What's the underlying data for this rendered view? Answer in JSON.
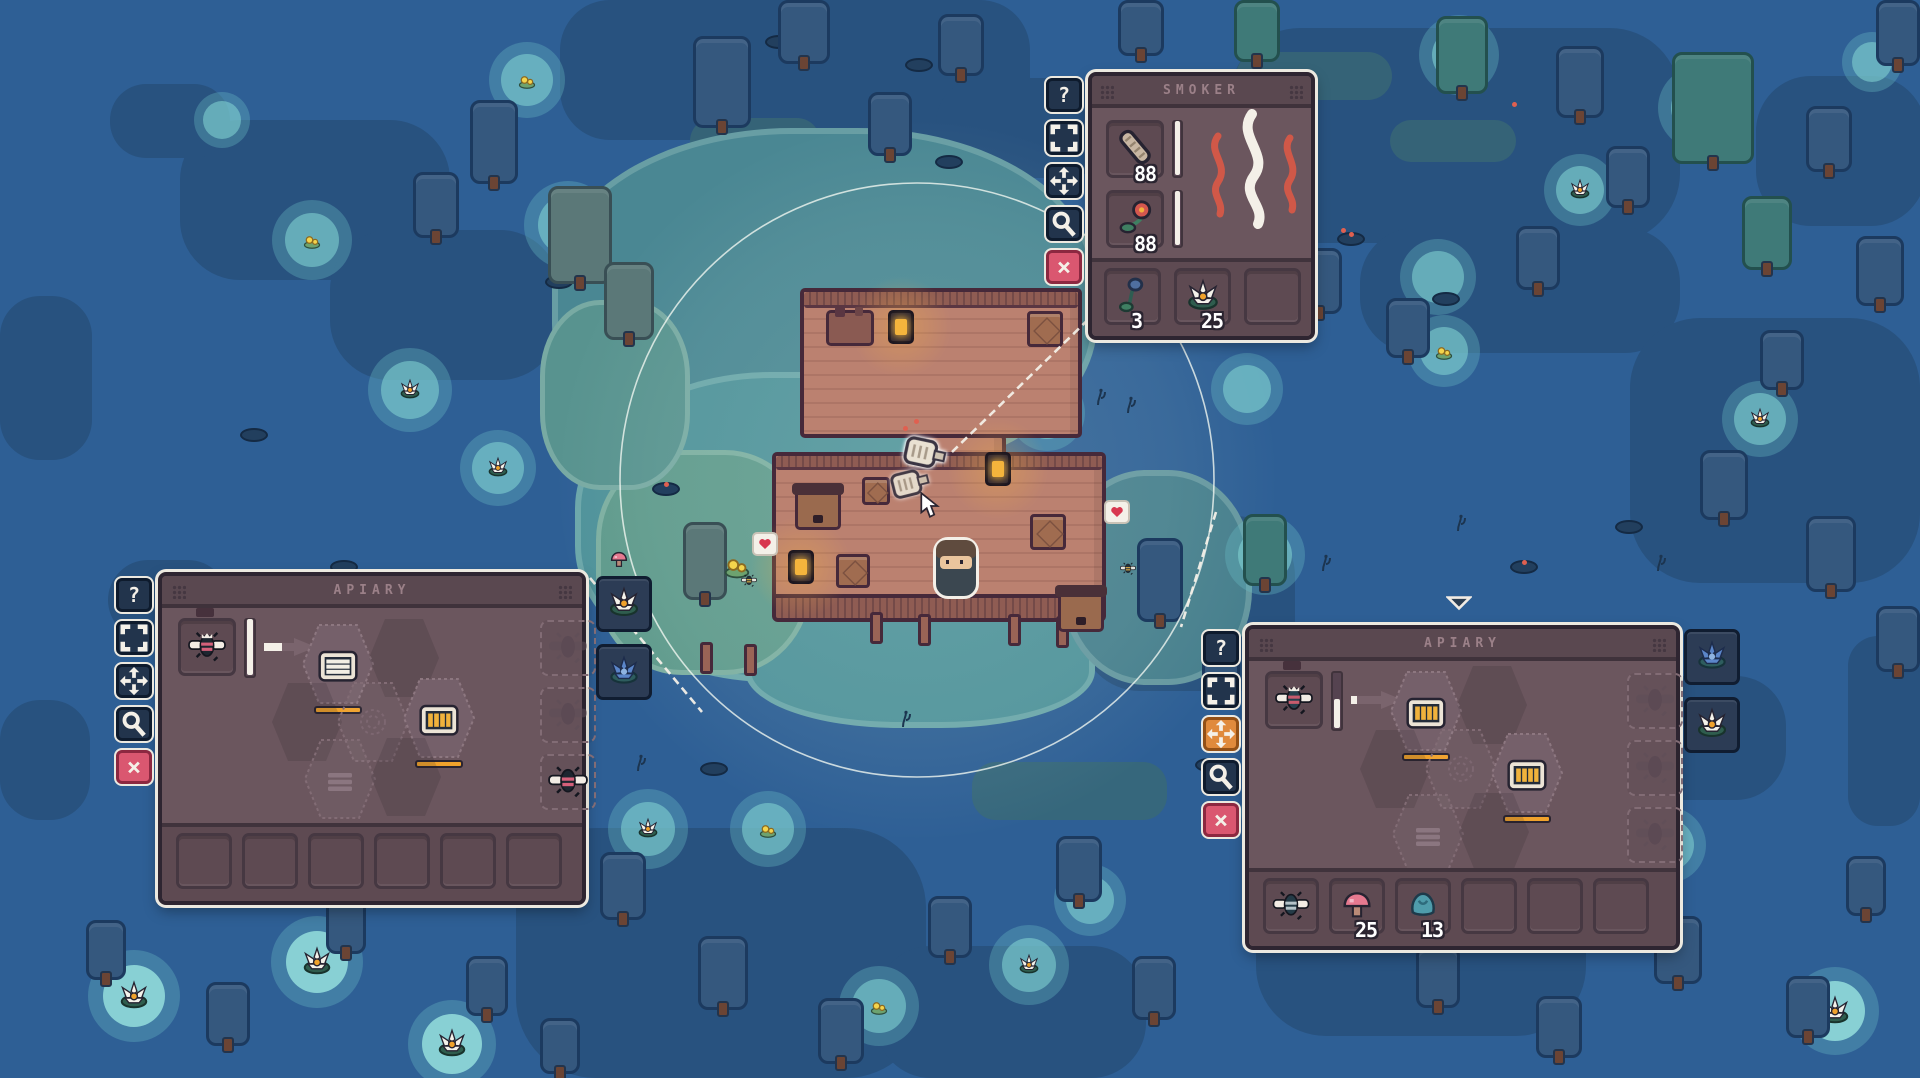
{
  "hud": {
    "button_glyphs": [
      "question",
      "expand",
      "fullscreen",
      "magnifier",
      "close"
    ],
    "smoker": {
      "title": "SMOKER",
      "x": 1088,
      "y": 72,
      "w": 227,
      "h": 268,
      "buttons": [
        {
          "name": "help",
          "glyph": "question",
          "accent": "none"
        },
        {
          "name": "resize",
          "glyph": "expand",
          "accent": "none"
        },
        {
          "name": "move",
          "glyph": "fullscreen",
          "accent": "none"
        },
        {
          "name": "inspect",
          "glyph": "magnifier",
          "accent": "none"
        },
        {
          "name": "close",
          "glyph": "close",
          "accent": "pink"
        }
      ],
      "fuel_slots": [
        {
          "item": "wood-log",
          "count": "88",
          "progress": 1
        },
        {
          "item": "red-flower",
          "count": "88",
          "progress": 1
        }
      ],
      "output_slots": [
        {
          "item": "bluebell",
          "count": "3"
        },
        {
          "item": "water-lily",
          "count": "25"
        },
        {
          "item": "",
          "count": ""
        }
      ]
    },
    "apiary_left": {
      "title": "APIARY",
      "x": 158,
      "y": 572,
      "w": 428,
      "h": 333,
      "buttons": [
        {
          "name": "help",
          "glyph": "question",
          "accent": "none"
        },
        {
          "name": "resize",
          "glyph": "expand",
          "accent": "none"
        },
        {
          "name": "move",
          "glyph": "fullscreen",
          "accent": "none"
        },
        {
          "name": "inspect",
          "glyph": "magnifier",
          "accent": "none"
        },
        {
          "name": "close",
          "glyph": "close",
          "accent": "pink"
        }
      ],
      "queen_item": "queen-bee",
      "queen_progress": 1,
      "arrow_progress": 0.35,
      "hexes": [
        {
          "dx": 176,
          "dy": 88,
          "kind": "comb-white",
          "bar": true
        },
        {
          "dx": 242,
          "dy": 82,
          "kind": "shadow",
          "bar": false
        },
        {
          "dx": 145,
          "dy": 146,
          "kind": "shadow",
          "bar": false
        },
        {
          "dx": 211,
          "dy": 146,
          "kind": "pattern",
          "bar": false
        },
        {
          "dx": 277,
          "dy": 142,
          "kind": "comb-gold",
          "bar": true
        },
        {
          "dx": 178,
          "dy": 203,
          "kind": "lines",
          "bar": false
        },
        {
          "dx": 244,
          "dy": 201,
          "kind": "shadow",
          "bar": false
        }
      ],
      "bee_slots": [
        "ghost",
        "ghost",
        "worker-bee"
      ],
      "bottom_slots": [
        {
          "item": "",
          "count": ""
        },
        {
          "item": "",
          "count": ""
        },
        {
          "item": "",
          "count": ""
        },
        {
          "item": "",
          "count": ""
        },
        {
          "item": "",
          "count": ""
        },
        {
          "item": "",
          "count": ""
        }
      ],
      "side_slots": [
        "water-lily",
        "blue-lotus"
      ]
    },
    "apiary_right": {
      "title": "APIARY",
      "x": 1245,
      "y": 625,
      "w": 435,
      "h": 325,
      "buttons": [
        {
          "name": "help",
          "glyph": "question",
          "accent": "none"
        },
        {
          "name": "resize",
          "glyph": "expand",
          "accent": "none"
        },
        {
          "name": "move",
          "glyph": "fullscreen",
          "accent": "orange"
        },
        {
          "name": "inspect",
          "glyph": "magnifier",
          "accent": "none"
        },
        {
          "name": "close",
          "glyph": "close",
          "accent": "pink"
        }
      ],
      "queen_item": "dark-queen-bee",
      "queen_progress": 0.52,
      "arrow_progress": 0.14,
      "hexes": [
        {
          "dx": 177,
          "dy": 82,
          "kind": "comb-gold",
          "bar": true
        },
        {
          "dx": 243,
          "dy": 76,
          "kind": "shadow",
          "bar": false
        },
        {
          "dx": 146,
          "dy": 140,
          "kind": "shadow",
          "bar": false
        },
        {
          "dx": 212,
          "dy": 140,
          "kind": "pattern",
          "bar": false
        },
        {
          "dx": 278,
          "dy": 144,
          "kind": "comb-gold",
          "bar": true
        },
        {
          "dx": 179,
          "dy": 205,
          "kind": "lines",
          "bar": false
        },
        {
          "dx": 245,
          "dy": 203,
          "kind": "shadow",
          "bar": false
        }
      ],
      "bee_slots": [
        "ghost",
        "ghost",
        "ghost"
      ],
      "bottom_slots": [
        {
          "item": "dark-bee",
          "count": ""
        },
        {
          "item": "pink-mushroom",
          "count": "25"
        },
        {
          "item": "teal-coral",
          "count": "13"
        },
        {
          "item": "",
          "count": ""
        },
        {
          "item": "",
          "count": ""
        },
        {
          "item": "",
          "count": ""
        }
      ],
      "side_slots": [
        "blue-lotus",
        "water-lily"
      ]
    }
  },
  "world": {
    "house": {
      "deck_top": [
        800,
        288,
        282,
        150
      ],
      "deck_mid": [
        772,
        452,
        334,
        150
      ],
      "connector": [
        922,
        434,
        84,
        26
      ],
      "wall_strip": [
        772,
        594,
        334,
        28
      ],
      "beehives": [
        [
          795,
          488
        ],
        [
          1058,
          590
        ]
      ],
      "crates": [
        [
          1027,
          311,
          36
        ],
        [
          1030,
          514,
          36
        ],
        [
          836,
          554,
          34
        ],
        [
          862,
          477,
          28
        ]
      ],
      "lanterns": [
        [
          888,
          310
        ],
        [
          985,
          452
        ],
        [
          788,
          550
        ]
      ],
      "table": [
        826,
        310
      ],
      "posts": [
        [
          870,
          612
        ],
        [
          918,
          614
        ],
        [
          1008,
          614
        ],
        [
          1056,
          616
        ],
        [
          700,
          642
        ],
        [
          744,
          644
        ]
      ]
    },
    "player": [
      936,
      540
    ],
    "cursor": [
      918,
      492
    ],
    "smoker_world": [
      901,
      432
    ],
    "smoker_ghost": [
      890,
      464
    ],
    "sparks": [
      [
        903,
        426
      ],
      [
        914,
        419
      ]
    ],
    "marker": [
      1446,
      594
    ],
    "link_lines": [
      [
        952,
        452,
        1098,
        310
      ],
      [
        590,
        578,
        702,
        712
      ],
      [
        1216,
        512,
        1181,
        627
      ]
    ],
    "hearts": [
      [
        752,
        532
      ],
      [
        1104,
        500
      ]
    ],
    "bees": [
      [
        741,
        572
      ],
      [
        1120,
        560
      ]
    ],
    "flower_clump": [
      722,
      550
    ],
    "light_ring": {
      "cx": 917,
      "cy": 480,
      "r": 297
    }
  },
  "map": {
    "patches": [
      [
        560,
        0,
        470,
        140,
        50
      ],
      [
        180,
        120,
        270,
        160,
        60
      ],
      [
        330,
        230,
        230,
        150,
        60
      ],
      [
        110,
        84,
        120,
        74,
        36
      ],
      [
        1230,
        28,
        450,
        215,
        70
      ],
      [
        1360,
        228,
        320,
        125,
        55
      ],
      [
        1630,
        318,
        290,
        265,
        70
      ],
      [
        1756,
        76,
        170,
        150,
        55
      ],
      [
        1080,
        516,
        215,
        175,
        60
      ],
      [
        936,
        78,
        175,
        100,
        45
      ],
      [
        1256,
        796,
        330,
        240,
        70
      ],
      [
        516,
        828,
        410,
        250,
        80
      ],
      [
        876,
        946,
        270,
        132,
        55
      ],
      [
        0,
        296,
        92,
        164,
        40
      ],
      [
        1848,
        636,
        72,
        190,
        30
      ],
      [
        1596,
        676,
        190,
        124,
        50
      ],
      [
        108,
        560,
        120,
        80,
        40
      ],
      [
        0,
        700,
        90,
        120,
        40
      ]
    ],
    "moss": [
      [
        972,
        762,
        195,
        58
      ],
      [
        1236,
        52,
        156,
        48
      ],
      [
        1390,
        120,
        126,
        42
      ],
      [
        690,
        118,
        130,
        46
      ],
      [
        1106,
        232,
        120,
        40
      ]
    ],
    "shallows": [
      [
        552,
        128,
        545,
        350,
        "#4a8793"
      ],
      [
        575,
        372,
        445,
        310,
        "#4f929a"
      ],
      [
        745,
        598,
        350,
        130,
        "#4f929a"
      ],
      [
        1062,
        470,
        190,
        215,
        "#477f8d"
      ]
    ],
    "grass": [
      [
        596,
        450,
        215,
        225,
        "#5f9a8c"
      ],
      [
        540,
        300,
        150,
        190,
        "#58938f"
      ]
    ],
    "ponds": [
      [
        527,
        80,
        38,
        "lily"
      ],
      [
        312,
        240,
        40,
        "lily"
      ],
      [
        410,
        390,
        42,
        "lilyw"
      ],
      [
        498,
        468,
        38,
        "lilyw"
      ],
      [
        134,
        996,
        46,
        "big"
      ],
      [
        317,
        962,
        46,
        "big"
      ],
      [
        452,
        1044,
        44,
        "big"
      ],
      [
        648,
        829,
        40,
        "lilyw"
      ],
      [
        768,
        829,
        38,
        "lily"
      ],
      [
        879,
        1006,
        40,
        "lily"
      ],
      [
        1029,
        965,
        40,
        "lilyw"
      ],
      [
        1281,
        812,
        40,
        "lilyw"
      ],
      [
        1564,
        845,
        38,
        "lily"
      ],
      [
        1668,
        845,
        38,
        "lilyw"
      ],
      [
        1835,
        1011,
        44,
        "big"
      ],
      [
        1090,
        900,
        36,
        "plain"
      ],
      [
        1047,
        413,
        38,
        "lilyw"
      ],
      [
        1247,
        389,
        36,
        "plain"
      ],
      [
        1444,
        351,
        36,
        "lily"
      ],
      [
        1760,
        419,
        38,
        "lilyw"
      ],
      [
        1580,
        190,
        36,
        "lilyw"
      ],
      [
        1438,
        277,
        38,
        "plain"
      ],
      [
        1700,
        108,
        42,
        "tree"
      ],
      [
        1459,
        55,
        40,
        "tree"
      ],
      [
        1265,
        555,
        40,
        "tree"
      ],
      [
        568,
        225,
        44,
        "tree"
      ],
      [
        1872,
        62,
        30,
        "plain"
      ],
      [
        222,
        120,
        28,
        "plain"
      ]
    ],
    "trees": [
      [
        413,
        172,
        46,
        66,
        "navy"
      ],
      [
        470,
        100,
        48,
        84,
        "navy"
      ],
      [
        548,
        186,
        64,
        98,
        "grey"
      ],
      [
        604,
        262,
        50,
        78,
        "grey"
      ],
      [
        693,
        36,
        58,
        92,
        "navy"
      ],
      [
        778,
        0,
        52,
        64,
        "navy"
      ],
      [
        868,
        92,
        44,
        64,
        "navy"
      ],
      [
        938,
        14,
        46,
        62,
        "navy"
      ],
      [
        1118,
        0,
        46,
        56,
        "navy"
      ],
      [
        1234,
        0,
        46,
        62,
        "teal"
      ],
      [
        1296,
        248,
        46,
        66,
        "navy"
      ],
      [
        1386,
        298,
        44,
        60,
        "navy"
      ],
      [
        1436,
        16,
        52,
        78,
        "teal"
      ],
      [
        1516,
        226,
        44,
        64,
        "navy"
      ],
      [
        1556,
        46,
        48,
        72,
        "navy"
      ],
      [
        1606,
        146,
        44,
        62,
        "navy"
      ],
      [
        1672,
        52,
        82,
        112,
        "teal"
      ],
      [
        1742,
        196,
        50,
        74,
        "teal"
      ],
      [
        1806,
        106,
        46,
        66,
        "navy"
      ],
      [
        1856,
        236,
        48,
        70,
        "navy"
      ],
      [
        1876,
        0,
        44,
        66,
        "navy"
      ],
      [
        1700,
        450,
        48,
        70,
        "navy"
      ],
      [
        1806,
        516,
        50,
        76,
        "navy"
      ],
      [
        1876,
        606,
        44,
        66,
        "navy"
      ],
      [
        1760,
        330,
        44,
        60,
        "navy"
      ],
      [
        1137,
        538,
        46,
        84,
        "navy"
      ],
      [
        1243,
        514,
        44,
        72,
        "teal"
      ],
      [
        1202,
        632,
        38,
        54,
        "navy"
      ],
      [
        600,
        852,
        46,
        68,
        "navy"
      ],
      [
        698,
        936,
        50,
        74,
        "navy"
      ],
      [
        818,
        998,
        46,
        66,
        "navy"
      ],
      [
        928,
        896,
        44,
        62,
        "navy"
      ],
      [
        1056,
        836,
        46,
        66,
        "navy"
      ],
      [
        1132,
        956,
        44,
        64,
        "navy"
      ],
      [
        1306,
        876,
        46,
        68,
        "navy"
      ],
      [
        1416,
        946,
        44,
        62,
        "navy"
      ],
      [
        1536,
        996,
        46,
        62,
        "navy"
      ],
      [
        1654,
        916,
        48,
        68,
        "navy"
      ],
      [
        1786,
        976,
        44,
        62,
        "navy"
      ],
      [
        1846,
        856,
        40,
        60,
        "navy"
      ],
      [
        86,
        920,
        40,
        60,
        "navy"
      ],
      [
        206,
        982,
        44,
        64,
        "navy"
      ],
      [
        326,
        896,
        40,
        58,
        "navy"
      ],
      [
        466,
        956,
        42,
        60,
        "navy"
      ],
      [
        540,
        1018,
        40,
        56,
        "navy"
      ],
      [
        683,
        522,
        44,
        78,
        "grey"
      ]
    ],
    "pads": [
      [
        765,
        35,
        ""
      ],
      [
        935,
        155,
        ""
      ],
      [
        545,
        275,
        ""
      ],
      [
        1337,
        232,
        "f"
      ],
      [
        1432,
        292,
        ""
      ],
      [
        1615,
        520,
        ""
      ],
      [
        700,
        762,
        ""
      ],
      [
        905,
        58,
        ""
      ],
      [
        1510,
        560,
        "f"
      ],
      [
        330,
        560,
        ""
      ],
      [
        240,
        428,
        ""
      ],
      [
        1195,
        758,
        ""
      ],
      [
        652,
        482,
        "f"
      ]
    ],
    "sprigs": [
      [
        1095,
        388
      ],
      [
        1125,
        396
      ],
      [
        1455,
        514
      ],
      [
        1018,
        554
      ],
      [
        900,
        710
      ],
      [
        1320,
        554
      ],
      [
        1655,
        554
      ],
      [
        635,
        754
      ],
      [
        1210,
        298
      ],
      [
        1470,
        640
      ]
    ],
    "mushrooms": [
      [
        608,
        548
      ]
    ],
    "fireflies": [
      [
        1341,
        228
      ],
      [
        1512,
        102
      ]
    ]
  },
  "colors": {
    "water": "#2e5f95",
    "water_shadow": "#28527f",
    "panel_bg": "#6b565e",
    "panel_border": "#2e2531",
    "accent_close": "#da5770",
    "accent_active": "#e08a3c",
    "progress_white": "#f4f0e8",
    "honey_bar": "#f0a22c",
    "deck": "#bb8170",
    "glow_teal": "#80d0d0",
    "smoke_red": "#d05848"
  }
}
